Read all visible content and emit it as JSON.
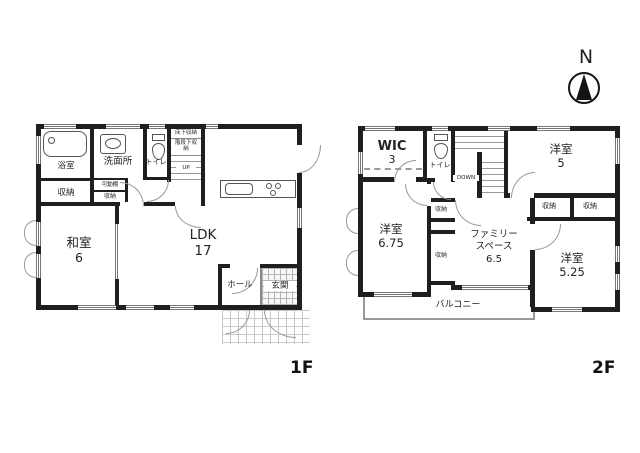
{
  "compass": {
    "north": "N"
  },
  "captions": {
    "floor1": "1F",
    "floor2": "2F"
  },
  "f1": {
    "bathroom": "浴室",
    "washroom": "洗面所",
    "toilet": "トイレ",
    "underfloor_storage": "床下収納",
    "understairs_storage": "階段下収納",
    "stairs_up": "UP",
    "movable_shelf": "可動棚",
    "closet_main": "収納",
    "closet_small": "収納",
    "japanese_room": "和室",
    "japanese_room_size": "6",
    "ldk": "LDK",
    "ldk_size": "17",
    "hall": "ホール",
    "entrance": "玄関"
  },
  "f2": {
    "wic": "WIC",
    "wic_size": "3",
    "toilet": "トイレ",
    "stairs_down": "DOWN",
    "bedroom_a": "洋室",
    "bedroom_a_size": "5",
    "bedroom_b": "洋室",
    "bedroom_b_size": "6.75",
    "bedroom_c": "洋室",
    "bedroom_c_size": "5.25",
    "family_space_line1": "ファミリー",
    "family_space_line2": "スペース",
    "family_space_size": "6.5",
    "closet_center_top": "収納",
    "closet_center_bottom": "収納",
    "closet_right_left": "収納",
    "closet_right_right": "収納",
    "balcony": "バルコニー"
  },
  "colors": {
    "wall": "#1f1f1f",
    "line": "#999999",
    "text": "#222222"
  }
}
